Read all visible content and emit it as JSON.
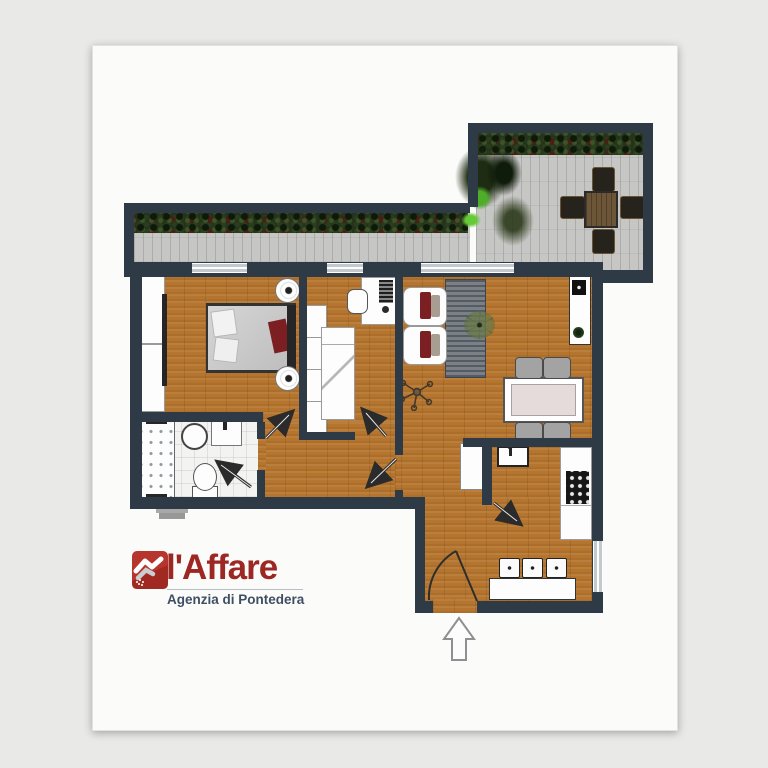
{
  "document": {
    "kind": "apartment-floor-plan"
  },
  "branding": {
    "name": "l'Affare",
    "subtitle": "Agenzia di Pontedera",
    "icon": "handshake-icon"
  },
  "compass": {
    "symbol": "north-arrow"
  },
  "colors": {
    "canvas-bg": "#e9e9e8",
    "page-bg": "#fbfbfa",
    "wall": "#2e3a45",
    "wood": "#b5752e",
    "tile": "#f3f3f1",
    "paving": "#c6c6c4",
    "hedge": "#25331b",
    "rug": "#6a6f76",
    "brand-red": "#9c2723",
    "subtitle-blue": "#3e4f63",
    "tabletop": "#e6dbdb",
    "outdoor-table": "#6d5637",
    "outdoor-chair": "#26231d",
    "fixture-white": "#fdfdfd",
    "accent-cushion": "#7c1f23"
  },
  "rooms": [
    {
      "name": "terrace",
      "furniture": [
        "hedge",
        "outdoor-dining-table",
        "outdoor-chairs",
        "potted-plants"
      ]
    },
    {
      "name": "balcony",
      "furniture": [
        "hedge"
      ]
    },
    {
      "name": "bedroom",
      "furniture": [
        "double-bed",
        "wardrobe",
        "nightstands-with-lamps"
      ]
    },
    {
      "name": "second-bedroom",
      "furniture": [
        "desk",
        "desk-chair",
        "wardrobe",
        "single-bed"
      ]
    },
    {
      "name": "bathroom",
      "furniture": [
        "shower",
        "round-washbasin",
        "square-basin",
        "toilet"
      ]
    },
    {
      "name": "living-dining",
      "furniture": [
        "lounge-chairs",
        "striped-rug",
        "plant",
        "dining-table",
        "dining-chairs",
        "tv-cabinet",
        "floor-lamp"
      ]
    },
    {
      "name": "kitchen",
      "furniture": [
        "sink",
        "cooktop",
        "counter",
        "breakfast-bar",
        "stools",
        "tall-cabinet"
      ]
    },
    {
      "name": "hallway",
      "furniture": []
    },
    {
      "name": "entrance",
      "furniture": [
        "front-door"
      ]
    }
  ]
}
